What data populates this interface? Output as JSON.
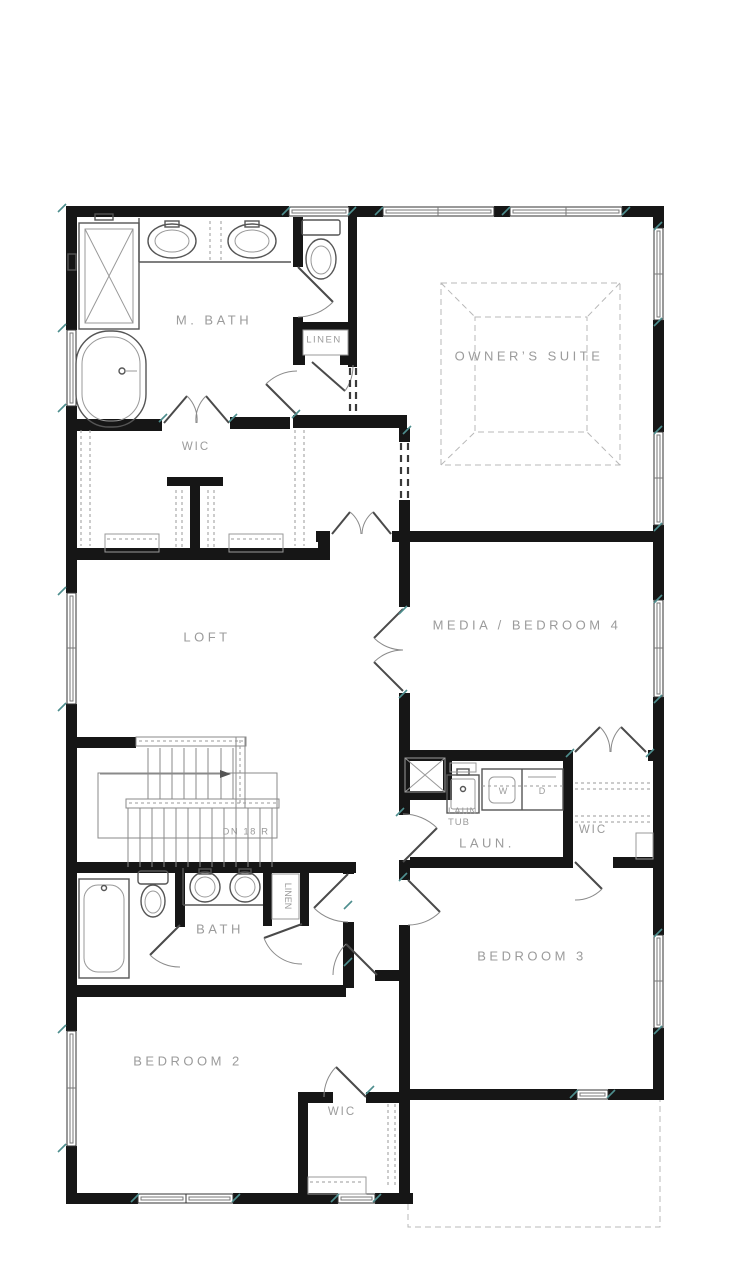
{
  "title": "Second floor plan",
  "labels": {
    "m_bath": "M. BATH",
    "linen_master": "LINEN",
    "wic_master": "WIC",
    "owners_suite": "OWNER’S SUITE",
    "loft": "LOFT",
    "media_bedroom4": "MEDIA / BEDROOM 4",
    "stairs_note": "DN 18 R",
    "laun_tub_1": "LAUN.",
    "laun_tub_2": "TUB",
    "washer": "W",
    "dryer": "D",
    "laundry": "LAUN.",
    "wic_bed3": "WIC",
    "bath": "BATH",
    "linen_bath": "LINEN",
    "bedroom3": "BEDROOM 3",
    "bedroom2": "BEDROOM 2",
    "wic_bed2": "WIC"
  },
  "colors": {
    "wall": "#161616",
    "room_label": "#9b9b9b",
    "window_tick": "#4e8e8e",
    "fixture_line": "#555555",
    "ceiling_dash": "#b8b8b8",
    "background": "#ffffff"
  },
  "stairs": {
    "direction": "DN",
    "risers": "18 R"
  }
}
